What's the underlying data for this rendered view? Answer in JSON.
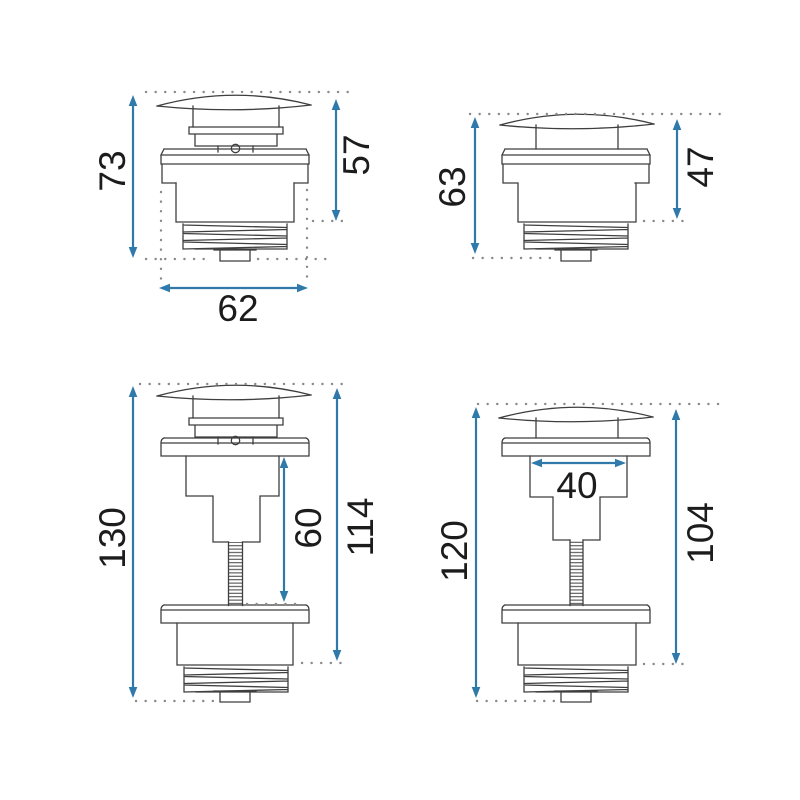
{
  "colors": {
    "background": "#ffffff",
    "dimension_arrow_blue": "#2f79ab",
    "drawing_line_gray": "#3f3f3f",
    "reference_dot_gray": "#8a8a8a",
    "dimension_text_black": "#1c1c1c"
  },
  "views": {
    "top_left": {
      "dimensions": {
        "total_height": "73",
        "depth_above_thread": "57",
        "width": "62"
      }
    },
    "top_right": {
      "dimensions": {
        "total_height": "63",
        "depth_above_thread": "47"
      }
    },
    "bottom_left": {
      "dimensions": {
        "total_height": "130",
        "rod_length": "60",
        "depth_above_thread": "114"
      }
    },
    "bottom_right": {
      "dimensions": {
        "total_height": "120",
        "body_width": "40",
        "depth_above_thread": "104"
      }
    }
  }
}
